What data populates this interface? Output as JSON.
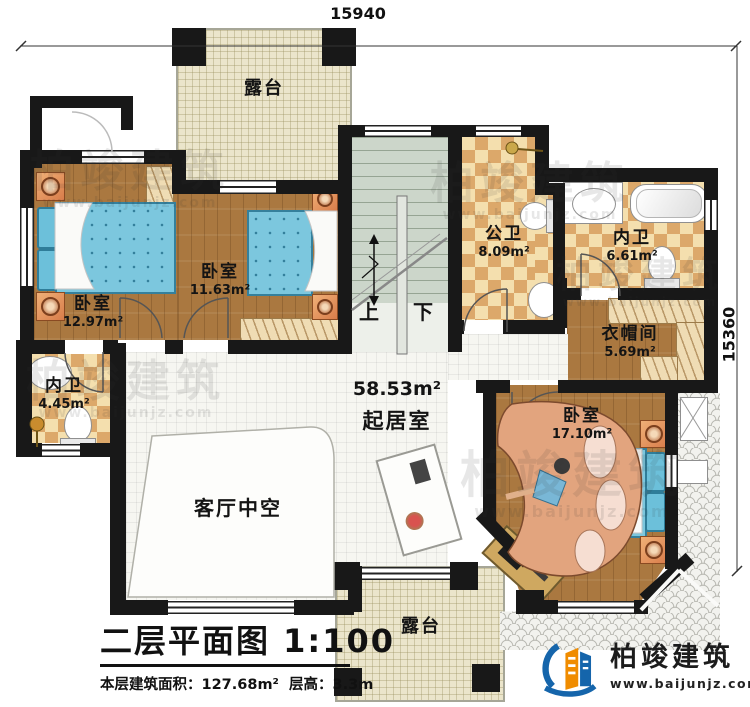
{
  "dimensions": {
    "width_top": "15940",
    "height_right": "15360"
  },
  "rooms": {
    "terrace_top": {
      "label": "露台"
    },
    "bedroom_left": {
      "label": "卧室",
      "area": "12.97m²"
    },
    "bedroom_mid": {
      "label": "卧室",
      "area": "11.63m²"
    },
    "bath_public": {
      "label": "公卫",
      "area": "8.09m²"
    },
    "bath_master": {
      "label": "内卫",
      "area": "6.61m²"
    },
    "cloakroom": {
      "label": "衣帽间",
      "area": "5.69m²"
    },
    "bath_left": {
      "label": "内卫",
      "area": "4.45m²"
    },
    "living": {
      "label": "起居室",
      "area": "58.53m²"
    },
    "void": {
      "label": "客厅中空"
    },
    "bedroom_right": {
      "label": "卧室",
      "area": "17.10m²"
    },
    "terrace_bottom": {
      "label": "露台"
    }
  },
  "stairs": {
    "up": "上",
    "down": "下"
  },
  "titleblock": {
    "title": "二层平面图",
    "scale": "1:100",
    "floor_area": "本层建筑面积：127.68m²",
    "floor_height": "层高：3.3m"
  },
  "brand": {
    "name": "柏竣建筑",
    "url": "www.baijunjz.com"
  },
  "watermark": {
    "name": "柏竣建筑",
    "url": "www.baijunjz.com"
  }
}
